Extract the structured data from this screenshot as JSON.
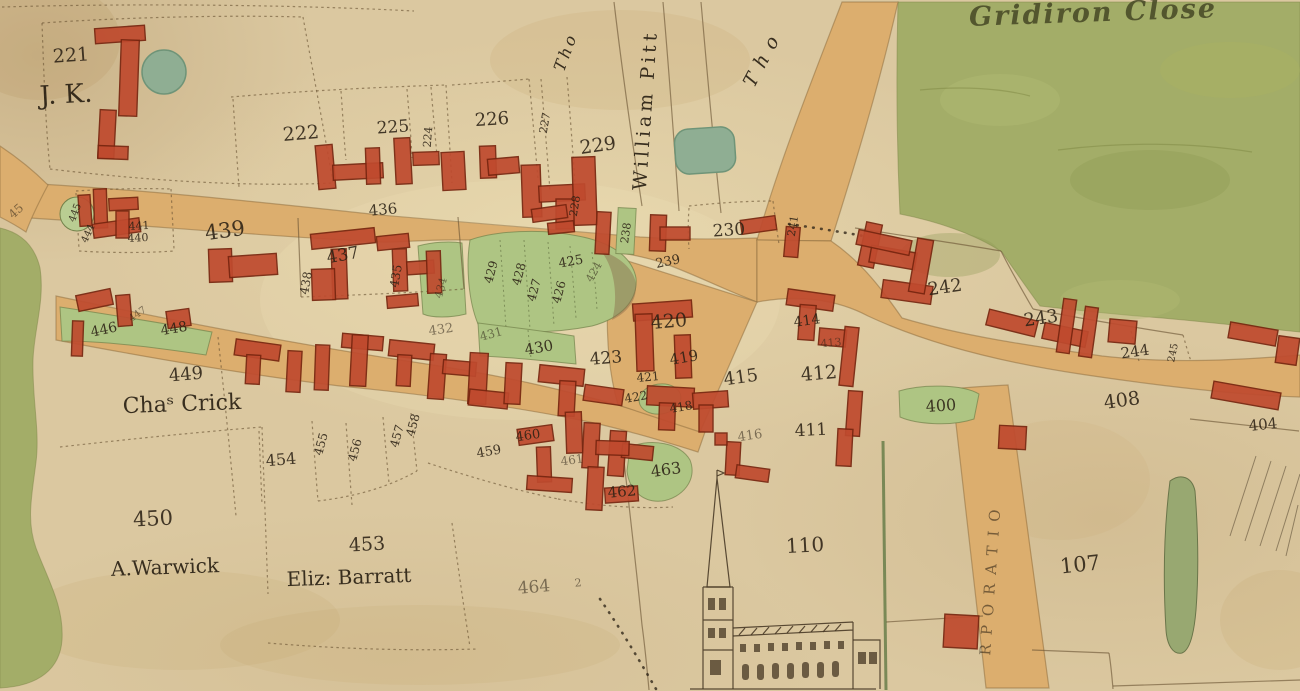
{
  "field_names": [
    {
      "id": "gridiron-close",
      "text": "Gridiron Close"
    }
  ],
  "owner_names": [
    {
      "id": "jk",
      "text": "J. K."
    },
    {
      "id": "william-pitt",
      "text": "William Pitt"
    },
    {
      "id": "tho-left",
      "text": "Tho"
    },
    {
      "id": "tho-right",
      "text": "Tho"
    },
    {
      "id": "cha-crick",
      "text": "Chaˢ Crick"
    },
    {
      "id": "a-warwick",
      "text": "A.Warwick"
    },
    {
      "id": "eliz-barratt",
      "text": "Eliz: Barratt"
    },
    {
      "id": "corporation",
      "text": "RPORATIO"
    }
  ],
  "parcel_numbers": [
    {
      "id": "p221",
      "text": "221"
    },
    {
      "id": "p222",
      "text": "222"
    },
    {
      "id": "p224",
      "text": "224"
    },
    {
      "id": "p225",
      "text": "225"
    },
    {
      "id": "p226",
      "text": "226"
    },
    {
      "id": "p227",
      "text": "227"
    },
    {
      "id": "p228",
      "text": "228"
    },
    {
      "id": "p229",
      "text": "229"
    },
    {
      "id": "p230",
      "text": "230"
    },
    {
      "id": "p238",
      "text": "238"
    },
    {
      "id": "p239",
      "text": "239"
    },
    {
      "id": "p241",
      "text": "241"
    },
    {
      "id": "p242",
      "text": "242"
    },
    {
      "id": "p243",
      "text": "243"
    },
    {
      "id": "p244",
      "text": "244"
    },
    {
      "id": "p245",
      "text": "245"
    },
    {
      "id": "p400",
      "text": "400"
    },
    {
      "id": "p404",
      "text": "404"
    },
    {
      "id": "p408",
      "text": "408"
    },
    {
      "id": "p411",
      "text": "411"
    },
    {
      "id": "p412",
      "text": "412"
    },
    {
      "id": "p413",
      "text": "413"
    },
    {
      "id": "p414",
      "text": "414"
    },
    {
      "id": "p415",
      "text": "415"
    },
    {
      "id": "p416",
      "text": "416"
    },
    {
      "id": "p418",
      "text": "418"
    },
    {
      "id": "p419",
      "text": "419"
    },
    {
      "id": "p420",
      "text": "420"
    },
    {
      "id": "p421",
      "text": "421"
    },
    {
      "id": "p422",
      "text": "422"
    },
    {
      "id": "p423",
      "text": "423"
    },
    {
      "id": "p424",
      "text": "424"
    },
    {
      "id": "p425",
      "text": "425"
    },
    {
      "id": "p426",
      "text": "426"
    },
    {
      "id": "p427",
      "text": "427"
    },
    {
      "id": "p428",
      "text": "428"
    },
    {
      "id": "p429",
      "text": "429"
    },
    {
      "id": "p430",
      "text": "430"
    },
    {
      "id": "p431",
      "text": "431"
    },
    {
      "id": "p432",
      "text": "432"
    },
    {
      "id": "p434",
      "text": "434"
    },
    {
      "id": "p435",
      "text": "435"
    },
    {
      "id": "p436",
      "text": "436"
    },
    {
      "id": "p437",
      "text": "437"
    },
    {
      "id": "p438",
      "text": "438"
    },
    {
      "id": "p439",
      "text": "439"
    },
    {
      "id": "p440",
      "text": "440"
    },
    {
      "id": "p441",
      "text": "441"
    },
    {
      "id": "p444",
      "text": "444"
    },
    {
      "id": "p445",
      "text": "445"
    },
    {
      "id": "p446",
      "text": "446"
    },
    {
      "id": "p447",
      "text": "447"
    },
    {
      "id": "p448",
      "text": "448"
    },
    {
      "id": "p449",
      "text": "449"
    },
    {
      "id": "p450",
      "text": "450"
    },
    {
      "id": "p453",
      "text": "453"
    },
    {
      "id": "p454",
      "text": "454"
    },
    {
      "id": "p455",
      "text": "455"
    },
    {
      "id": "p456",
      "text": "456"
    },
    {
      "id": "p457",
      "text": "457"
    },
    {
      "id": "p458",
      "text": "458"
    },
    {
      "id": "p459",
      "text": "459"
    },
    {
      "id": "p460",
      "text": "460"
    },
    {
      "id": "p461",
      "text": "461"
    },
    {
      "id": "p462",
      "text": "462"
    },
    {
      "id": "p463",
      "text": "463"
    },
    {
      "id": "p464",
      "text": "464"
    },
    {
      "id": "p110",
      "text": "110"
    },
    {
      "id": "p107",
      "text": "107"
    }
  ],
  "annotations": [
    {
      "id": "road-45",
      "text": "45"
    },
    {
      "id": "p464sup",
      "text": "2"
    }
  ],
  "colors": {
    "paper": "#dbc8a0",
    "paper_light": "#ead9b1",
    "paper_dark": "#c4ab7e",
    "road": "#dcae6e",
    "field_green": "#a3ad68",
    "garden_green": "#aec583",
    "pond_green": "#8fae93",
    "building_red": "#bf4a2e",
    "building_edge": "#77250f",
    "ink": "#32281a",
    "boundary": "#6b5434",
    "hedge_green": "#59743f"
  }
}
